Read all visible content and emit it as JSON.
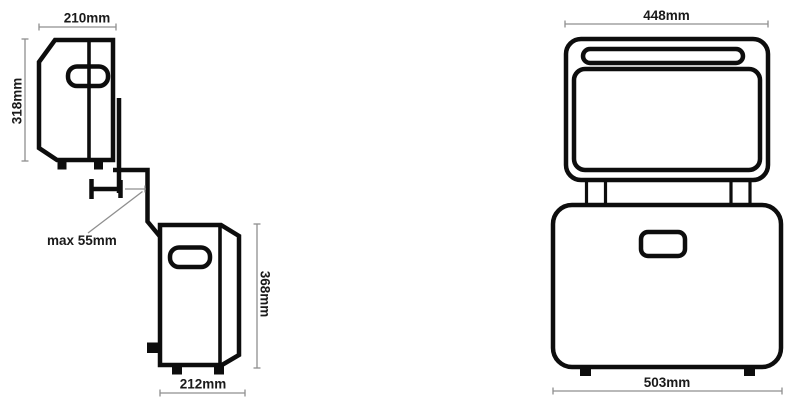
{
  "diagram": {
    "title": "product-dimension-drawing",
    "background": "#ffffff"
  },
  "labels": {
    "upper_width": "210mm",
    "upper_height": "318mm",
    "clamp_max": "max 55mm",
    "lower_height": "368mm",
    "lower_width": "212mm",
    "front_lid_width": "448mm",
    "front_body_width": "503mm"
  },
  "colors": {
    "outline": "#0d0d0d",
    "dimension_line": "#8f8f8f",
    "label_text": "#1a1a1a",
    "background": "#ffffff"
  }
}
